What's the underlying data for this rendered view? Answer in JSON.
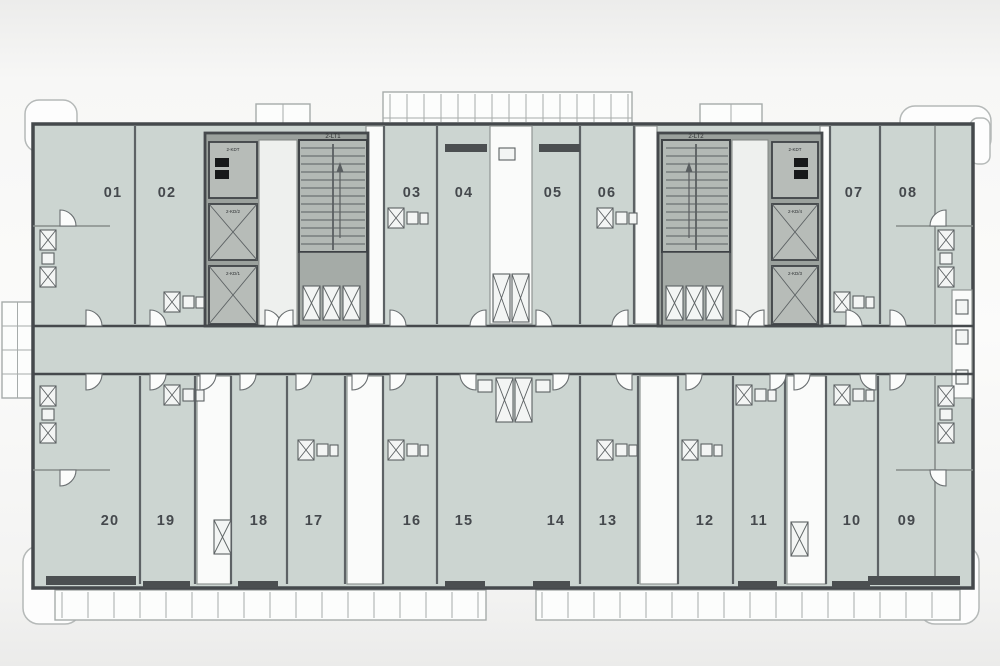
{
  "units": [
    {
      "label": "01"
    },
    {
      "label": "02"
    },
    {
      "label": "03"
    },
    {
      "label": "04"
    },
    {
      "label": "05"
    },
    {
      "label": "06"
    },
    {
      "label": "07"
    },
    {
      "label": "08"
    },
    {
      "label": "09"
    },
    {
      "label": "10"
    },
    {
      "label": "11"
    },
    {
      "label": "12"
    },
    {
      "label": "13"
    },
    {
      "label": "14"
    },
    {
      "label": "15"
    },
    {
      "label": "16"
    },
    {
      "label": "17"
    },
    {
      "label": "18"
    },
    {
      "label": "19"
    },
    {
      "label": "20"
    }
  ],
  "cores": {
    "left": {
      "stair_label": "2-LT1",
      "elevators": [
        "2-KDT",
        "2-KD/2",
        "2-KD/1"
      ]
    },
    "right": {
      "stair_label": "2-LT2",
      "elevators": [
        "2-KDT",
        "2-KD/4",
        "2-KD/3"
      ]
    }
  },
  "colors": {
    "paper": "#f4f4f3",
    "unit_fill": "#ccd5d1",
    "core_fill": "#9ba19d",
    "lobby_fill": "#eef0ee",
    "stair_fill": "#b3b9b5",
    "shaft_fill": "#b7bcb8",
    "wall": "#45494c",
    "wall_mid": "#5d6265",
    "label": "#45494d"
  }
}
